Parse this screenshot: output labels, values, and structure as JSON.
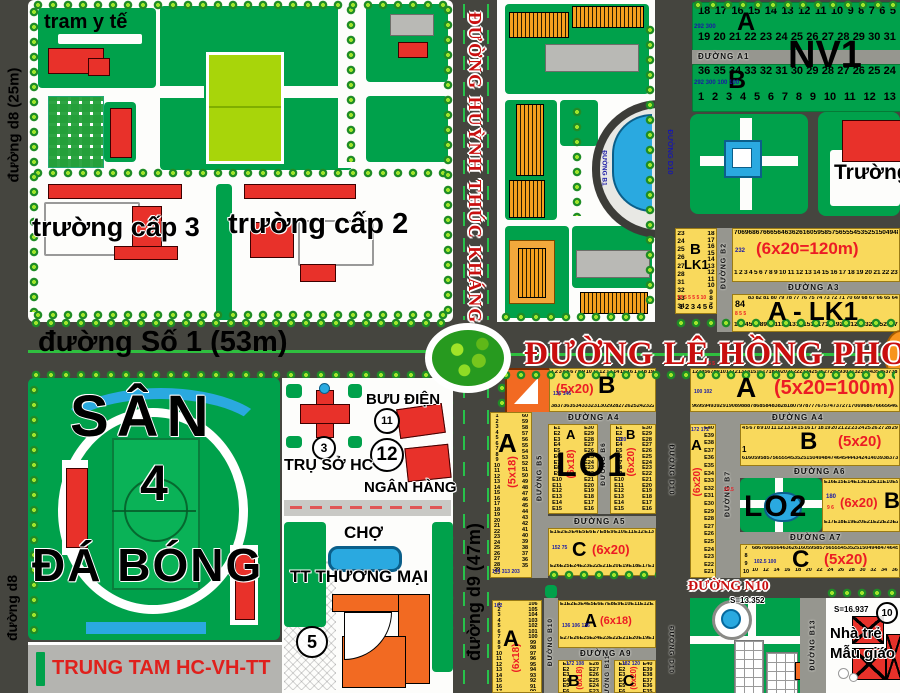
{
  "colors": {
    "road": "#45453f",
    "park_green": "#00a14b",
    "field_lime": "#a8d50a",
    "lot_yellow": "#f9d95c",
    "building_red": "#e8312a",
    "building_orange": "#f5a01e",
    "market_orange": "#f26a22",
    "water_blue": "#2aa9e0",
    "avenue_red_text": "#c90f0f",
    "dim_red": "#ec1c24",
    "lot_num_blue": "#1a1aa6"
  },
  "streets": {
    "d8_top": "đường d8 (25m)",
    "d8_bottom": "đường d8",
    "so1": "đường Số 1 (53m)",
    "htk": "ĐƯỜNG HUỲNH THÚC KHÁNG",
    "lhp": "ĐƯỜNG LÊ HỒNG PHONG",
    "d9": "đường d9 (47m)",
    "a1": "ĐƯỜNG A1",
    "a3": "ĐƯỜNG A3",
    "a4l": "ĐƯỜNG A4",
    "a4r": "ĐƯỜNG A4",
    "a5": "ĐƯỜNG A5",
    "a6": "ĐƯỜNG A6",
    "a7": "ĐƯỜNG A7",
    "a9": "ĐƯỜNG A9",
    "n10": "ĐƯỜNG N10",
    "b1": "ĐƯỜNG B1",
    "b2": "ĐƯỜNG B2",
    "b5": "ĐƯỜNG B5",
    "b6": "ĐƯỜNG B6",
    "b7": "ĐƯỜNG B7",
    "b10": "ĐƯỜNG B10",
    "b11": "ĐƯỜNG B11",
    "b13": "ĐƯỜNG B13",
    "d10_top": "ĐƯỜNG D10",
    "d10_mid": "ĐƯỜNG D10",
    "d10_bot": "ĐƯỜNG D10"
  },
  "civic": {
    "tram": "tram y tế",
    "school3": "trường cấp 3",
    "school2": "trường cấp 2",
    "truong": "Trường",
    "san": "SÂN",
    "san_num": "4",
    "dabong": "ĐÁ BÓNG",
    "trungtam": "TRUNG TAM HC-VH-TT",
    "truso": "TRỤ SỞ HC",
    "truso_num": "3",
    "buudien": "BƯU ĐIỆN",
    "buudien_num": "11",
    "nganhang_num": "12",
    "nganhang": "NGÂN HÀNG",
    "cho": "CHỢ",
    "thuongmai": "TT THƯƠNG MẠI",
    "market_num": "5",
    "s_park": "S=13.352",
    "s_kinder": "S=16.937",
    "kinder_num": "10",
    "kinder1": "Nhà trẻ",
    "kinder2": "Mẫu giáo"
  },
  "nv1": {
    "label": "NV1",
    "label_a": "A",
    "label_b": "B",
    "blue_a": "292 300",
    "blue_b": "292 300 100 100",
    "a_row1": [
      18,
      17,
      16,
      15,
      14,
      13,
      12,
      11,
      10,
      9,
      8,
      7,
      6,
      5
    ],
    "a_row2": [
      19,
      20,
      21,
      22,
      23,
      24,
      25,
      26,
      27,
      28,
      29,
      30,
      31
    ],
    "b_row1": [
      36,
      35,
      34,
      33,
      32,
      31,
      30,
      29,
      28,
      27,
      26,
      25,
      24
    ],
    "b_row2": [
      1,
      2,
      3,
      4,
      5,
      6,
      7,
      8,
      9,
      10,
      11,
      12,
      13
    ]
  },
  "blk": {
    "lo1_label": "LO1",
    "lo2_label": "LO2",
    "lo2_red": "20.5",
    "blk1": {
      "l1": "B",
      "l2": "LK1",
      "red": "10 5 5 5 5 10",
      "left": [
        23,
        24,
        25,
        26,
        27,
        28,
        31,
        32,
        33,
        34
      ],
      "right": [
        18,
        17,
        16,
        15,
        14,
        13,
        12,
        11,
        10,
        9,
        8,
        7
      ],
      "bottom": [
        1,
        2,
        3,
        4,
        5,
        6
      ]
    },
    "b120": {
      "dim": "(6x20=120m)",
      "blue": "232",
      "top": [
        70,
        69,
        68,
        67,
        66,
        65,
        64,
        63,
        62,
        61,
        60,
        59,
        58,
        57,
        56,
        55,
        54,
        53,
        52,
        51,
        50,
        49,
        48
      ],
      "bottom": [
        1,
        2,
        3,
        4,
        5,
        6,
        7,
        8,
        9,
        10,
        11,
        12,
        13,
        14,
        15,
        16,
        17,
        18,
        19,
        20,
        21,
        22,
        23
      ]
    },
    "alk1": {
      "label": "A - LK1",
      "corner": "84",
      "red": "8 5 5",
      "top": [
        83,
        82,
        81,
        80,
        79,
        78,
        77,
        76,
        75,
        74,
        73,
        72,
        71,
        70,
        69,
        68,
        67,
        66,
        65,
        64
      ],
      "bottom": [
        1,
        2,
        3,
        4,
        5,
        6,
        7,
        8,
        9,
        10,
        11,
        12,
        13,
        14,
        15,
        16,
        17,
        18,
        19,
        20,
        21,
        22,
        23,
        24,
        25,
        26,
        27
      ]
    },
    "colA1": {
      "label": "A",
      "dim": "(5x18)",
      "blue": "144 313 203",
      "left": [
        1,
        2,
        3,
        4,
        5,
        6,
        7,
        8,
        9,
        10,
        11,
        12,
        13,
        14,
        15,
        16,
        17,
        18,
        19,
        20,
        21,
        22,
        23,
        24,
        25,
        26,
        27,
        28,
        29,
        30
      ],
      "right": [
        60,
        59,
        58,
        57,
        56,
        55,
        54,
        53,
        52,
        51,
        50,
        49,
        48,
        47,
        46,
        45,
        44,
        43,
        42,
        41,
        40,
        39,
        38,
        37,
        36,
        35
      ]
    },
    "lo1top": {
      "label": "B",
      "dim": "(5x20)",
      "red": "7 5 5",
      "blue": "136 146",
      "top": [
        1,
        2,
        3,
        4,
        5,
        6,
        7,
        8,
        9,
        10,
        11,
        12,
        13,
        14,
        15,
        16,
        17,
        18,
        19
      ],
      "bottom": [
        38,
        37,
        36,
        35,
        34,
        33,
        32,
        31,
        30,
        29,
        28,
        27,
        26,
        25,
        24,
        23,
        22,
        21,
        20
      ]
    },
    "lo1a": {
      "corner": "A",
      "dim": "(6x18)",
      "left": [
        "E1",
        "E2",
        "E3",
        "E4",
        "E5",
        "E6",
        "E7",
        "E8",
        "E9",
        "E10",
        "E11",
        "E12",
        "E13",
        "E14",
        "E15"
      ],
      "right": [
        "E30",
        "E29",
        "E28",
        "E27",
        "E26",
        "E25",
        "E24",
        "E23",
        "E22",
        "E21",
        "E20",
        "E19",
        "E18",
        "E17",
        "E16"
      ]
    },
    "lo1b": {
      "corner": "B",
      "dim": "(6x20)",
      "blue": "120",
      "left": [
        "E1",
        "E2",
        "E3",
        "E4",
        "E5",
        "E6",
        "E7",
        "E8",
        "E9",
        "E10",
        "E11",
        "E12",
        "E13",
        "E14",
        "E15"
      ],
      "right": [
        "E30",
        "E29",
        "E28",
        "E27",
        "E26",
        "E25",
        "E24",
        "E23",
        "E22",
        "E21",
        "E20",
        "E19",
        "E18",
        "E17",
        "E16"
      ]
    },
    "lo1c": {
      "corner": "C",
      "dim": "(6x20)",
      "blue": "152 75",
      "top": [
        "E1",
        "E2",
        "E3",
        "E4",
        "E5",
        "E6",
        "E7",
        "E8",
        "E9",
        "E10",
        "E11",
        "E12",
        "E13"
      ],
      "bottom": [
        "E26",
        "E25",
        "E24",
        "E23",
        "E22",
        "E21",
        "E20",
        "E19",
        "E18",
        "E17",
        "E16",
        "E15",
        "E14"
      ]
    },
    "ra": {
      "label": "A",
      "dim": "(5x20=100m)",
      "red": "10 5 5 5",
      "blue": "100 102",
      "top": [
        1,
        2,
        3,
        4,
        5,
        6,
        7,
        8,
        9,
        10,
        11,
        12,
        13,
        14,
        15,
        16,
        17,
        18,
        19,
        20,
        21,
        22,
        23,
        24,
        25,
        26,
        27,
        28,
        29,
        30,
        31,
        32,
        33,
        34,
        35,
        36,
        37,
        38
      ],
      "bottom": [
        96,
        95,
        94,
        93,
        92,
        91,
        90,
        89,
        88,
        87,
        86,
        85,
        84,
        83,
        82,
        81,
        80,
        79,
        78,
        77,
        76,
        75,
        74,
        73,
        72,
        71,
        70,
        69,
        68,
        67,
        66,
        65,
        64,
        63,
        62,
        61,
        60,
        59
      ]
    },
    "rcola": {
      "label": "A",
      "dim": "(6x20)",
      "blue": "172 172",
      "col": [
        "E40",
        "E39",
        "E38",
        "E37",
        "E36",
        "E35",
        "E34",
        "E33",
        "E32",
        "E31",
        "E30",
        "E29",
        "E28",
        "E27",
        "E26",
        "E25",
        "E24",
        "E23",
        "E22",
        "E21"
      ]
    },
    "rb": {
      "label": "B",
      "dim": "(5x20)",
      "one": "1",
      "top": [
        4,
        5,
        6,
        7,
        8,
        9,
        10,
        11,
        12,
        13,
        14,
        15,
        16,
        17,
        18,
        19,
        20,
        21,
        22,
        23,
        24,
        25,
        26,
        27,
        28,
        29
      ],
      "bottom": [
        61,
        60,
        59,
        58,
        57,
        56,
        55,
        54,
        53,
        52,
        51,
        50,
        49,
        48,
        47,
        46,
        45,
        44,
        43,
        42,
        41,
        40,
        39,
        38,
        37,
        36
      ]
    },
    "lo2b": {
      "label": "B",
      "dim": "(6x20)",
      "blue": "180",
      "red": "9 6",
      "top": [
        "E16",
        "E15",
        "E14",
        "E13",
        "E12",
        "E11",
        "E10",
        "E9",
        "E8"
      ],
      "bottom": [
        "E17",
        "E18",
        "E19",
        "E20",
        "E21",
        "E22",
        "E23",
        "E24",
        "E25"
      ]
    },
    "rc": {
      "label": "C",
      "dim": "(5x20)",
      "blue": "102.5 100",
      "leftcol": [
        7,
        8,
        9,
        10
      ],
      "top": [
        68,
        67,
        66,
        65,
        64,
        63,
        62,
        61,
        60,
        59,
        58,
        57,
        56,
        55,
        54,
        53,
        52,
        51,
        50,
        49,
        48,
        47,
        46,
        45
      ],
      "bottom": [
        10,
        12,
        14,
        16,
        18,
        20,
        22,
        24,
        26,
        28,
        30,
        32,
        34,
        36
      ]
    },
    "colA2": {
      "label": "A",
      "dim": "(6x18)",
      "blue": "162",
      "left": [
        1,
        2,
        3,
        4,
        5,
        6,
        7,
        8,
        9,
        10,
        11,
        12,
        13,
        14,
        15,
        16,
        17,
        18,
        19,
        20
      ],
      "right": [
        106,
        105,
        104,
        103,
        102,
        101,
        100,
        99,
        98,
        97,
        96,
        95,
        94,
        93,
        92,
        91,
        90,
        89
      ]
    },
    "a618": {
      "label": "A",
      "dim": "(6x18)",
      "blue": "136 106 136",
      "top": [
        "E1",
        "E2",
        "E3",
        "E4",
        "E5",
        "E6",
        "E7",
        "E8",
        "E9",
        "E10",
        "E11",
        "E12",
        "E13"
      ],
      "bottom": [
        "E27",
        "E26",
        "E25",
        "E24",
        "E23",
        "E22",
        "E21",
        "E20",
        "E19",
        "E18",
        "E17",
        "E16",
        "E15"
      ]
    },
    "b618": {
      "label": "B",
      "dim": "(6x18)",
      "blue": "172 108",
      "left": [
        "E1",
        "E2",
        "E3",
        "E4",
        "E5",
        "E6",
        "E7",
        "E8"
      ],
      "right": [
        "E28",
        "E27",
        "E26",
        "E25",
        "E24",
        "E23",
        "E22",
        "E21"
      ]
    },
    "c620": {
      "label": "C",
      "dim": "(6x20)",
      "blue": "182 120",
      "left": [
        "E1",
        "E2",
        "E3",
        "E4",
        "E5",
        "E6",
        "E7",
        "E8"
      ],
      "right": [
        "E40",
        "E39",
        "E38",
        "E37",
        "E36",
        "E35",
        "E34",
        "E33"
      ]
    }
  }
}
